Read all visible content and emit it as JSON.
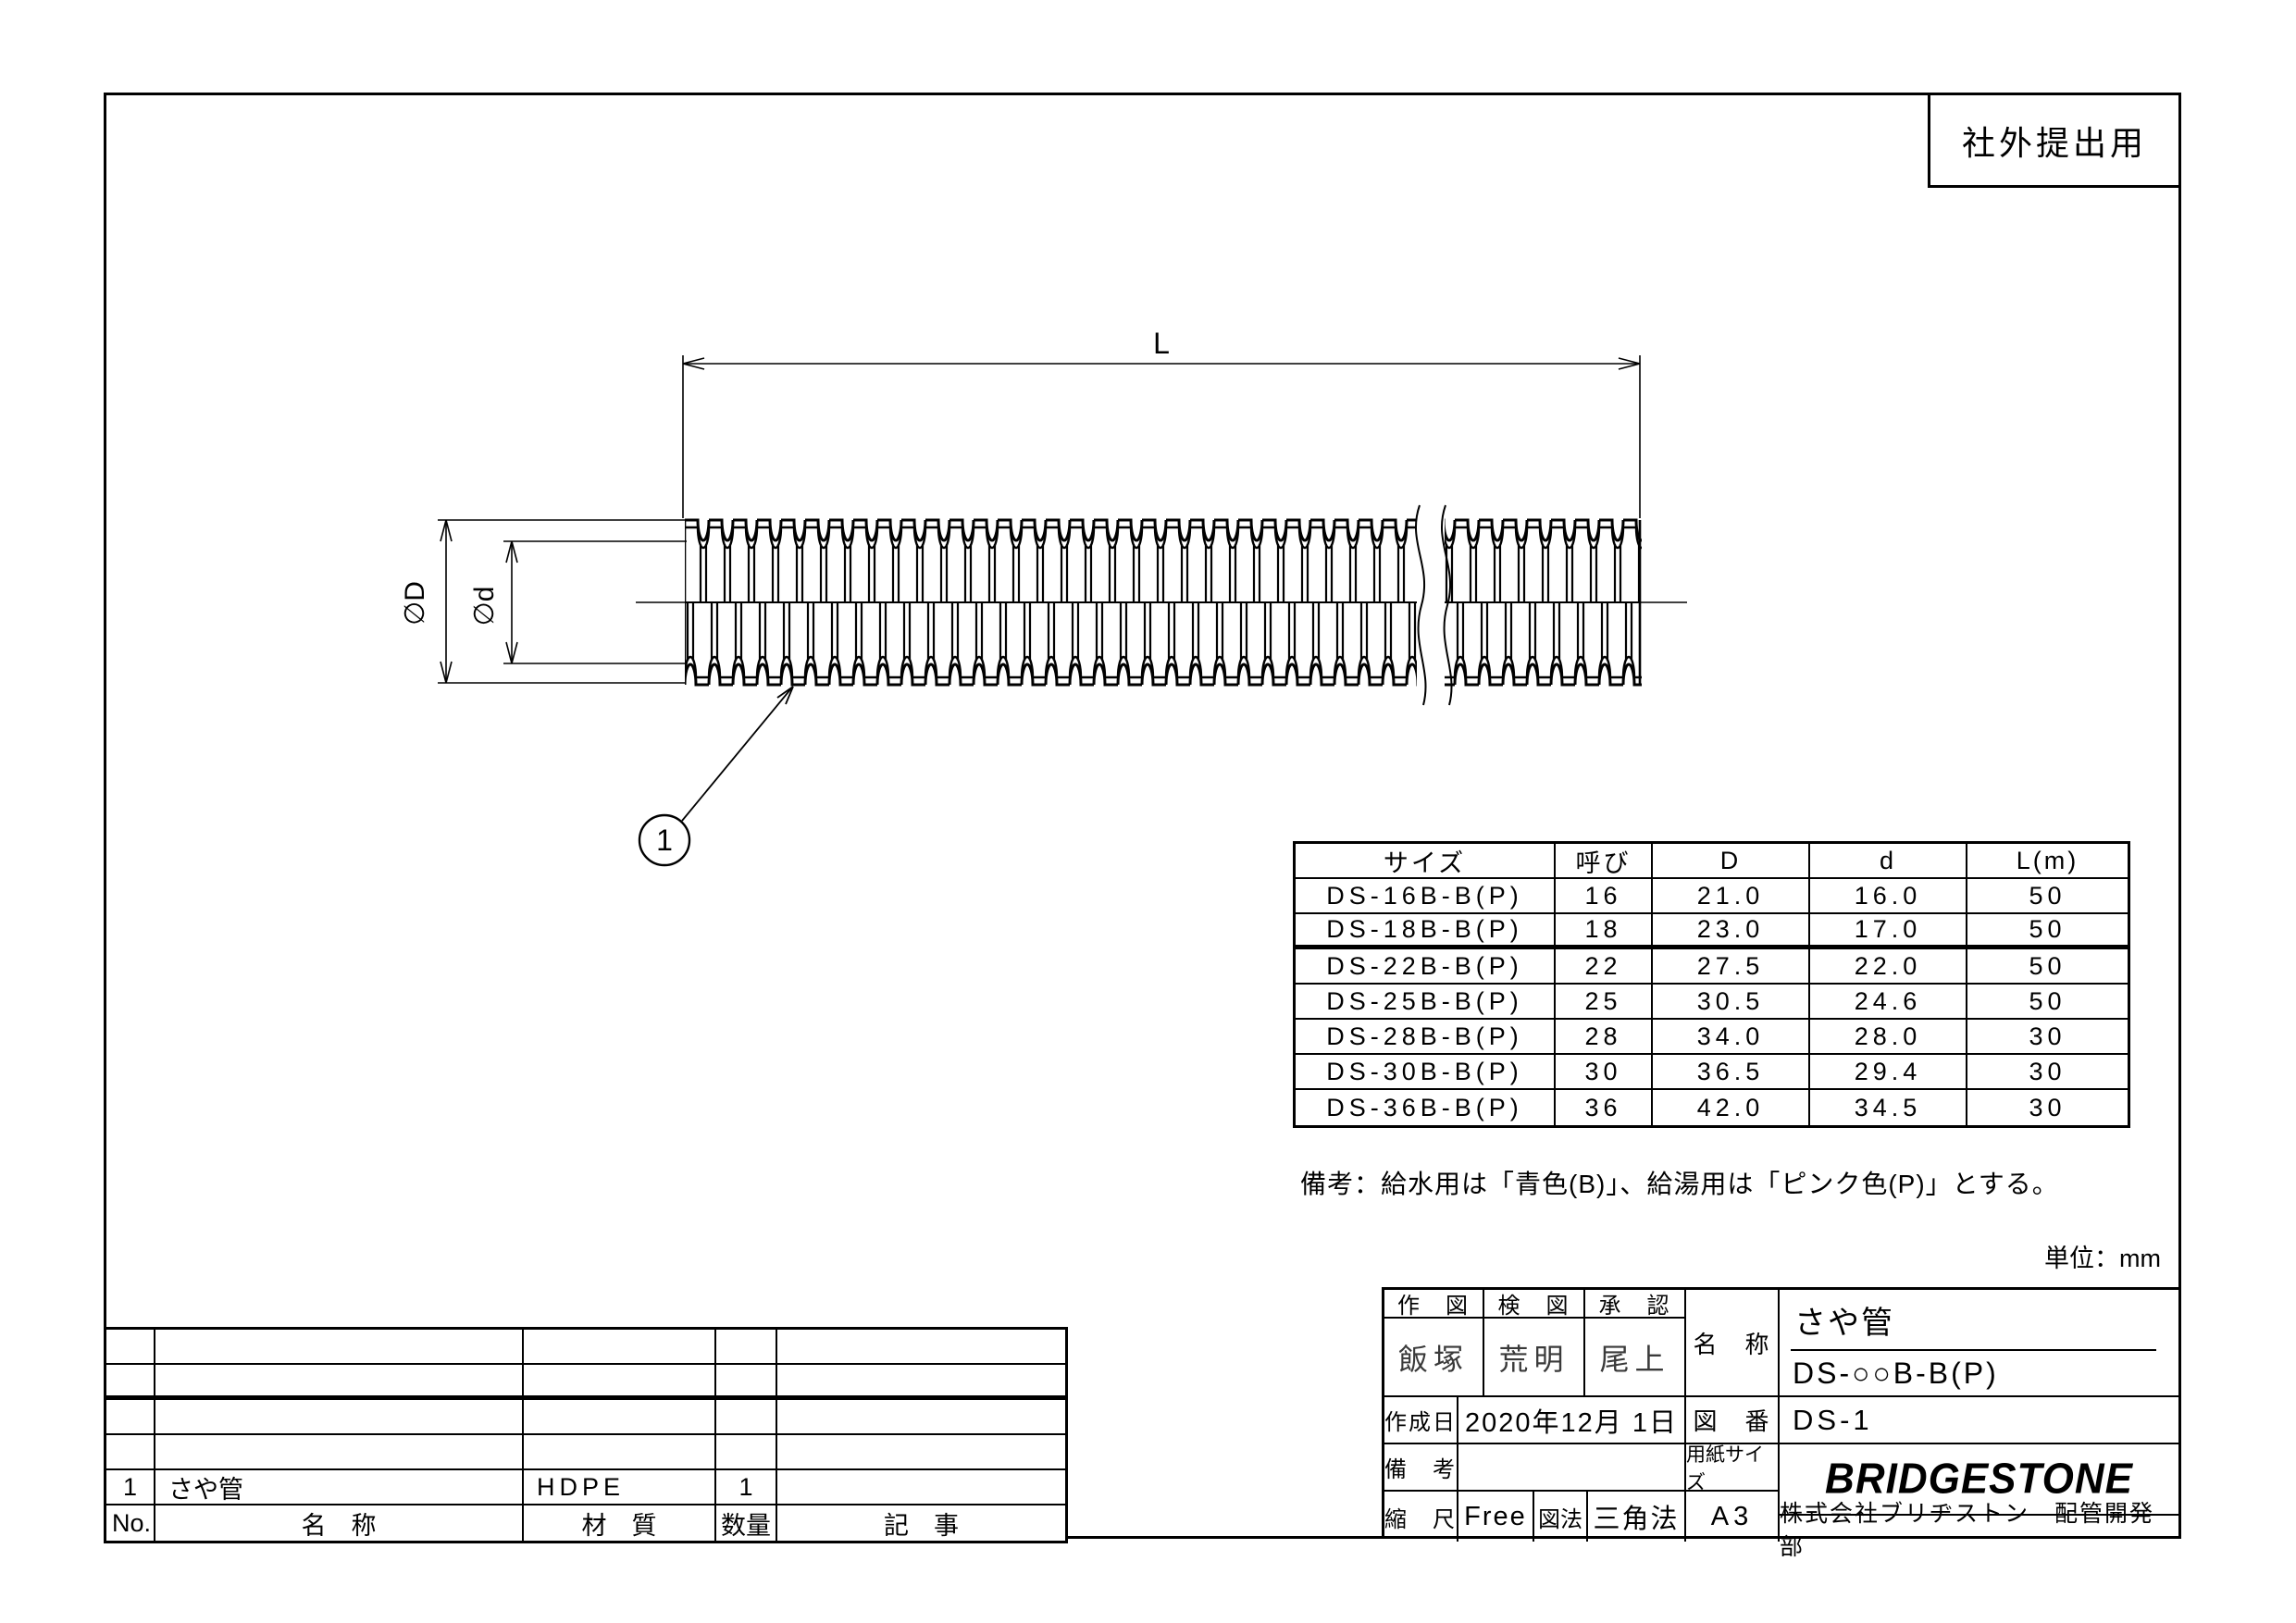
{
  "stamp": {
    "label": "社外提出用"
  },
  "drawing": {
    "length_label": "L",
    "outer_dia_label": "∅D",
    "inner_dia_label": "∅d",
    "balloon_number": "1"
  },
  "size_table": {
    "headers": [
      "サイズ",
      "呼び",
      "D",
      "d",
      "L(m)"
    ],
    "rows": [
      [
        "DS-16B-B(P)",
        "16",
        "21.0",
        "16.0",
        "50"
      ],
      [
        "DS-18B-B(P)",
        "18",
        "23.0",
        "17.0",
        "50"
      ],
      [
        "DS-22B-B(P)",
        "22",
        "27.5",
        "22.0",
        "50"
      ],
      [
        "DS-25B-B(P)",
        "25",
        "30.5",
        "24.6",
        "50"
      ],
      [
        "DS-28B-B(P)",
        "28",
        "34.0",
        "28.0",
        "30"
      ],
      [
        "DS-30B-B(P)",
        "30",
        "36.5",
        "29.4",
        "30"
      ],
      [
        "DS-36B-B(P)",
        "36",
        "42.0",
        "34.5",
        "30"
      ]
    ]
  },
  "note": "備考：給水用は「青色(B)」、給湯用は「ピンク色(P)」とする。",
  "unit_label": "単位：mm",
  "parts_table": {
    "headers": [
      "No.",
      "名　称",
      "材　質",
      "数量",
      "記　事"
    ],
    "row": {
      "no": "1",
      "name": "さや管",
      "material": "HDPE",
      "qty": "1",
      "remarks": ""
    }
  },
  "title_block": {
    "drawn_label": "作　図",
    "checked_label": "検　図",
    "approved_label": "承　認",
    "drawn_by": "飯塚",
    "checked_by": "荒明",
    "approved_by": "尾上",
    "name_label": "名　称",
    "name_line1": "さや管",
    "name_line2": "DS-○○B-B(P)",
    "date_label": "作成日",
    "date_value": "2020年12月 1日",
    "drawing_no_label": "図　番",
    "drawing_no_value": "DS-1",
    "remarks_label": "備　考",
    "remarks_value": "",
    "paper_size_label": "用紙サイズ",
    "paper_size_value": "A3",
    "scale_label": "縮　尺",
    "scale_value": "Free",
    "projection_label": "図法",
    "projection_value": "三角法",
    "logo_text": "BRIDGESTONE",
    "company_text": "株式会社ブリヂストン　配管開発部"
  },
  "colors": {
    "line": "#000000",
    "paper": "#ffffff"
  }
}
